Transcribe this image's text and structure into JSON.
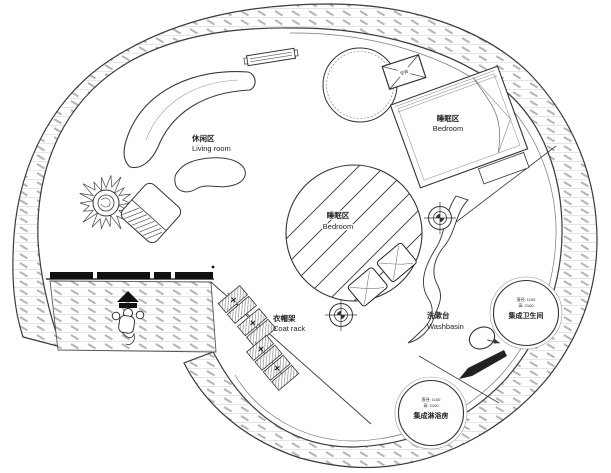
{
  "areas": {
    "living": {
      "cn": "休闲区",
      "en": "Living room"
    },
    "bedroom_loft": {
      "cn": "睡眠区",
      "en": "Bedroom"
    },
    "bedroom_main": {
      "cn": "睡眠区",
      "en": "Bedroom"
    },
    "coat_rack": {
      "cn": "衣帽架",
      "en": "Coat rack"
    },
    "washbasin": {
      "cn": "洗漱台",
      "en": "Washbasin"
    },
    "bathroom_pod": {
      "cn": "集成卫生间",
      "dim_diameter": "直径: 1100",
      "dim_height": "高: 2100"
    },
    "shower_pod": {
      "cn": "集成淋浴房",
      "dim_diameter": "直径: 1100",
      "dim_height": "高: 2100"
    },
    "ac_unit": {
      "cn": "空调"
    }
  },
  "colors": {
    "line": "#3a3a3a",
    "hatch_dash": "#b5b5b5",
    "hatch_guide": "#dddddd",
    "door_fill": "#111111",
    "background": "#ffffff"
  }
}
